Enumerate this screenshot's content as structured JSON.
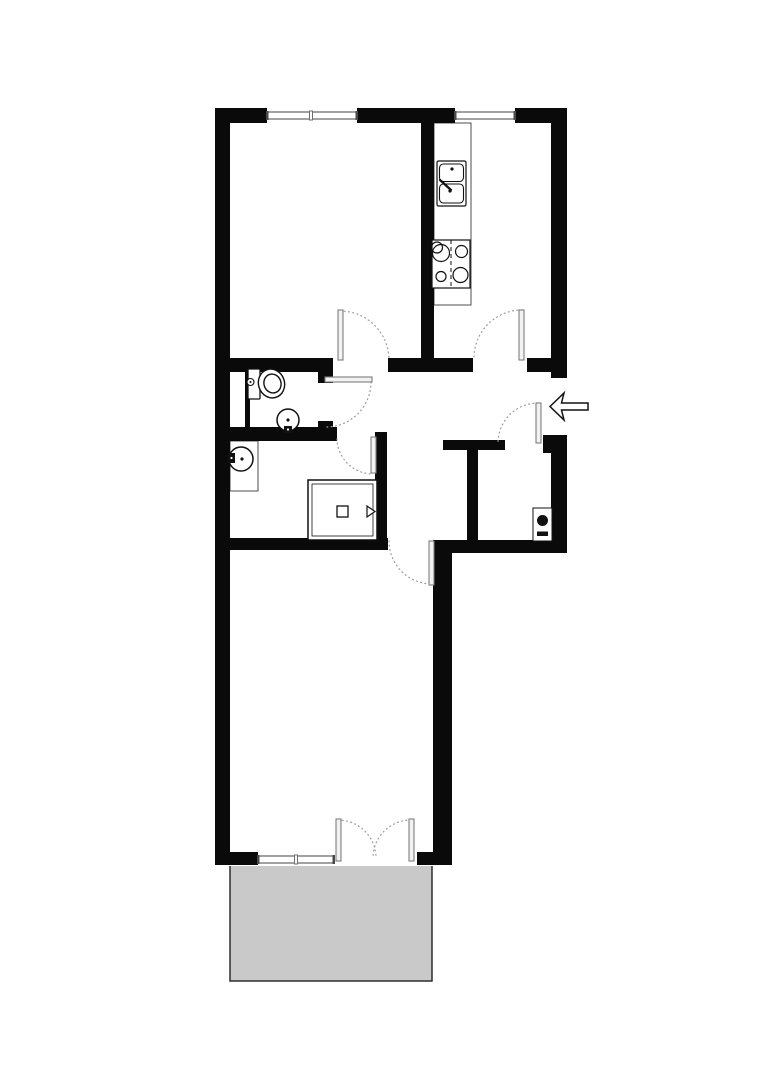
{
  "canvas": {
    "w": 764,
    "h": 1080,
    "bg": "#ffffff"
  },
  "colors": {
    "wall": "#0a0a0a",
    "fixture": "#111111",
    "leaf_fill": "#f2f2f2",
    "leaf_stroke": "#7d7d7d",
    "arc": "#9a9a9a",
    "window_fill": "#ffffff",
    "window_stroke": "#6f6f6f",
    "window_tick": "#4a4a4a",
    "counter_stroke": "#4d4d4d",
    "balcony_fill": "#c9c9c9",
    "balcony_stroke": "#2e2e2e"
  },
  "walls": [
    {
      "name": "top-wall-left",
      "x": 215,
      "y": 108,
      "w": 52,
      "h": 15
    },
    {
      "name": "top-wall-mid",
      "x": 357,
      "y": 108,
      "w": 98,
      "h": 15
    },
    {
      "name": "top-wall-right",
      "x": 515,
      "y": 108,
      "w": 52,
      "h": 15
    },
    {
      "name": "left-wall",
      "x": 215,
      "y": 108,
      "w": 15,
      "h": 757
    },
    {
      "name": "right-wall-upper",
      "x": 551,
      "y": 108,
      "w": 16,
      "h": 270
    },
    {
      "name": "entry-jamb-block",
      "x": 543,
      "y": 435,
      "w": 24,
      "h": 18
    },
    {
      "name": "right-wall-mid",
      "x": 551,
      "y": 440,
      "w": 16,
      "h": 113
    },
    {
      "name": "hall-bottom-wall",
      "x": 452,
      "y": 540,
      "w": 115,
      "h": 13
    },
    {
      "name": "living-right-wall",
      "x": 433,
      "y": 540,
      "w": 19,
      "h": 325
    },
    {
      "name": "bottom-wall-left",
      "x": 215,
      "y": 852,
      "w": 43,
      "h": 13
    },
    {
      "name": "bottom-wall-right",
      "x": 417,
      "y": 852,
      "w": 35,
      "h": 13
    },
    {
      "name": "kitchen-divider-wall",
      "x": 421,
      "y": 123,
      "w": 13,
      "h": 235
    },
    {
      "name": "mid-wall-left",
      "x": 215,
      "y": 358,
      "w": 118,
      "h": 14
    },
    {
      "name": "mid-wall-center",
      "x": 388,
      "y": 358,
      "w": 85,
      "h": 14
    },
    {
      "name": "mid-wall-right",
      "x": 527,
      "y": 358,
      "w": 24,
      "h": 14
    },
    {
      "name": "wc-duct-wall",
      "x": 245,
      "y": 360,
      "w": 5,
      "h": 81
    },
    {
      "name": "wc-jamb-top",
      "x": 318,
      "y": 370,
      "w": 15,
      "h": 13
    },
    {
      "name": "wc-jamb-bottom",
      "x": 318,
      "y": 421,
      "w": 15,
      "h": 20
    },
    {
      "name": "bath-top-wall",
      "x": 215,
      "y": 427,
      "w": 122,
      "h": 14
    },
    {
      "name": "bath-right-wall",
      "x": 375,
      "y": 432,
      "w": 12,
      "h": 118
    },
    {
      "name": "bath-bottom-wall",
      "x": 215,
      "y": 538,
      "w": 173,
      "h": 12
    },
    {
      "name": "closet-top-wall",
      "x": 443,
      "y": 440,
      "w": 62,
      "h": 10
    },
    {
      "name": "closet-divider-wall",
      "x": 467,
      "y": 450,
      "w": 11,
      "h": 90
    }
  ],
  "windows": [
    {
      "name": "window-room-left",
      "x": 267,
      "y": 112,
      "w": 90,
      "h": 7,
      "dividers": [
        311
      ]
    },
    {
      "name": "window-kitchen",
      "x": 455,
      "y": 112,
      "w": 60,
      "h": 7,
      "dividers": []
    },
    {
      "name": "window-living",
      "x": 258,
      "y": 856,
      "w": 76,
      "h": 7,
      "dividers": [
        296
      ]
    }
  ],
  "doors": [
    {
      "name": "door-room-left",
      "leaf": {
        "x": 338,
        "y": 310,
        "w": 5,
        "h": 50
      },
      "arc": "M 340 311 A 49 49 0 0 1 389 360"
    },
    {
      "name": "door-kitchen",
      "leaf": {
        "x": 519,
        "y": 310,
        "w": 5,
        "h": 50
      },
      "arc": "M 522 310 A 48 48 0 0 0 474 358"
    },
    {
      "name": "door-wc",
      "leaf": {
        "x": 325,
        "y": 377,
        "w": 47,
        "h": 5
      },
      "arc": "M 371 382 A 45 45 0 0 1 326 427"
    },
    {
      "name": "door-bath",
      "leaf": {
        "x": 371,
        "y": 437,
        "w": 5,
        "h": 36
      },
      "arc": "M 337 439 A 36 36 0 0 0 373 474"
    },
    {
      "name": "door-living",
      "leaf": {
        "x": 429,
        "y": 541,
        "w": 5,
        "h": 44
      },
      "arc": "M 389 541 A 43 43 0 0 0 432 584"
    },
    {
      "name": "door-entrance",
      "leaf": {
        "x": 536,
        "y": 403,
        "w": 5,
        "h": 40
      },
      "arc": "M 538 403 A 40 40 0 0 0 498 443"
    },
    {
      "name": "door-balcony-left",
      "leaf": {
        "x": 336,
        "y": 819,
        "w": 5,
        "h": 42
      },
      "arc": "M 338 820 A 38 38 0 0 1 376 858"
    },
    {
      "name": "door-balcony-right",
      "leaf": {
        "x": 409,
        "y": 819,
        "w": 5,
        "h": 42
      },
      "arc": "M 411 820 A 38 38 0 0 0 373 858"
    }
  ],
  "balcony": {
    "x": 230,
    "y": 866,
    "w": 202,
    "h": 115
  },
  "fixtures": {
    "kitchen_counter": {
      "x": 434,
      "y": 123,
      "w": 37,
      "h": 182
    },
    "sink": {
      "outer": {
        "x": 437,
        "y": 161,
        "w": 29,
        "h": 45
      },
      "basins": [
        {
          "x": 439.5,
          "y": 164,
          "w": 24,
          "h": 17.5
        },
        {
          "x": 439.5,
          "y": 184,
          "w": 24,
          "h": 19
        }
      ],
      "dots": [
        [
          452,
          169
        ],
        [
          450,
          191
        ]
      ],
      "faucet": [
        440,
        180,
        451,
        190
      ]
    },
    "stove": {
      "box": {
        "x": 432,
        "y": 240,
        "w": 38,
        "h": 48
      },
      "dash_x": 451,
      "burners": [
        [
          441,
          253,
          8.5
        ],
        [
          437,
          247.5,
          5.5
        ],
        [
          461.5,
          251.5,
          6
        ],
        [
          441,
          276.5,
          5
        ],
        [
          460.5,
          275,
          7.5
        ]
      ]
    },
    "toilet": {
      "tank": {
        "x": 248,
        "y": 369,
        "w": 12,
        "h": 30
      },
      "knob": [
        250.5,
        382,
        3.5
      ],
      "bowl": {
        "cx": 271.5,
        "cy": 383.5,
        "rx": 13,
        "ry": 14.5,
        "rot": -18
      },
      "bowl_inner": {
        "cx": 272.5,
        "cy": 383.5,
        "rx": 8.5,
        "ry": 9.5,
        "rot": -18
      }
    },
    "wc_basin": {
      "circle": [
        288,
        420,
        11
      ],
      "dot": [
        288,
        420,
        1.6
      ],
      "tap": {
        "x": 284,
        "y": 426,
        "w": 8,
        "h": 7
      }
    },
    "bath_counter": {
      "x": 230,
      "y": 441,
      "w": 28,
      "h": 50
    },
    "bath_basin": {
      "circle": [
        241,
        459,
        12
      ],
      "dot": [
        242,
        459,
        1.6
      ],
      "tap": {
        "x": 228,
        "y": 453,
        "w": 7,
        "h": 10
      }
    },
    "washer": {
      "outer": {
        "x": 308,
        "y": 480,
        "w": 69,
        "h": 60
      },
      "inner": {
        "x": 312,
        "y": 484,
        "w": 61,
        "h": 52
      },
      "square": {
        "x": 337,
        "y": 506,
        "w": 11,
        "h": 11
      },
      "triangle": "367,506 367,517 375,511.5"
    },
    "boiler": {
      "box": {
        "x": 533,
        "y": 508,
        "w": 19,
        "h": 33
      },
      "circle": [
        542.5,
        520.5,
        5.5
      ],
      "bar": {
        "x": 537,
        "y": 531.5,
        "w": 11,
        "h": 4.5
      }
    }
  },
  "entry_arrow": {
    "points": "550,406.5 564,393 561.5,403 588,403 588,410 561.5,410 564,420"
  }
}
